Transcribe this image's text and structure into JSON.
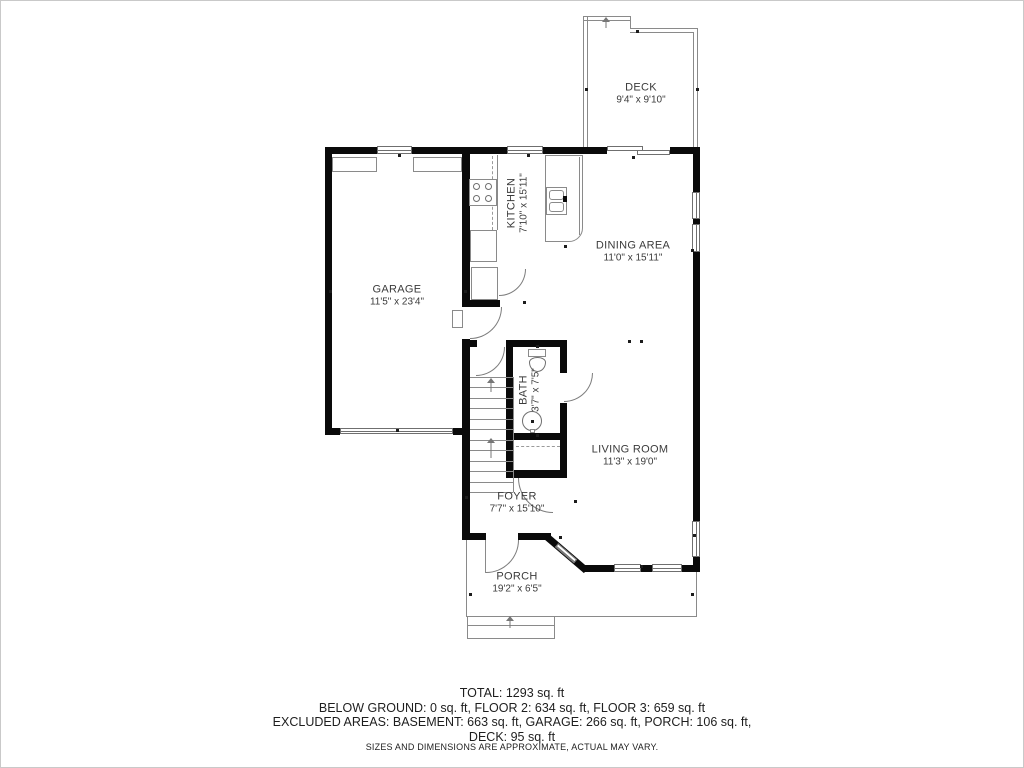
{
  "rooms": {
    "deck": {
      "name": "DECK",
      "dims": "9'4\" x 9'10\""
    },
    "garage": {
      "name": "GARAGE",
      "dims": "11'5\" x 23'4\""
    },
    "kitchen": {
      "name": "KITCHEN",
      "dims": "7'10\" x 15'11\""
    },
    "dining": {
      "name": "DINING AREA",
      "dims": "11'0\" x 15'11\""
    },
    "bath": {
      "name": "BATH",
      "dims": "3'7\" x 7'5\""
    },
    "living": {
      "name": "LIVING ROOM",
      "dims": "11'3\" x 19'0\""
    },
    "foyer": {
      "name": "FOYER",
      "dims": "7'7\" x 15'10\""
    },
    "porch": {
      "name": "PORCH",
      "dims": "19'2\" x 6'5\""
    }
  },
  "summary": {
    "line1": "TOTAL: 1293 sq. ft",
    "line2": "BELOW GROUND: 0 sq. ft, FLOOR 2: 634 sq. ft, FLOOR 3: 659 sq. ft",
    "line3": "EXCLUDED AREAS: BASEMENT: 663 sq. ft, GARAGE: 266 sq. ft, PORCH: 106 sq. ft,",
    "line4": "DECK: 95 sq. ft",
    "disclaimer": "SIZES AND DIMENSIONS ARE APPROXIMATE, ACTUAL MAY VARY."
  },
  "colors": {
    "wall": "#0a0a0a",
    "thin_line": "#8a8a8a",
    "text": "#3b3b3b"
  }
}
